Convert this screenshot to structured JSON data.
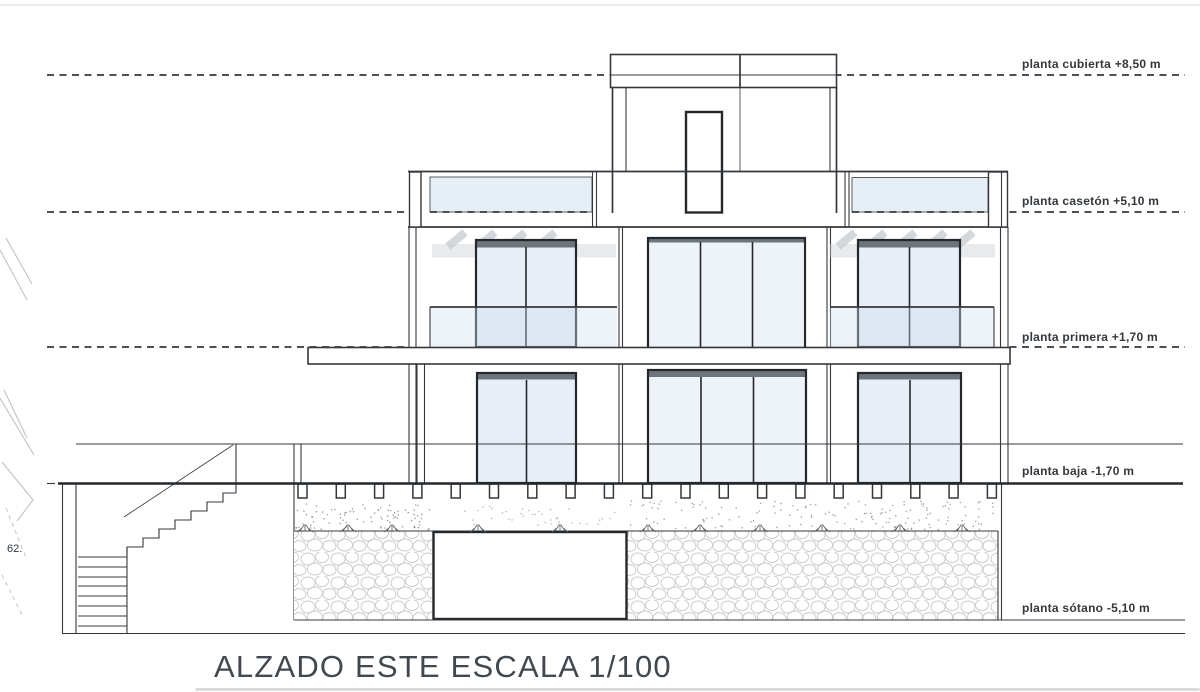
{
  "palette": {
    "line": "#34383c",
    "bold": "#24282c",
    "glass": "#cfdfee",
    "wglass": "#e7eef6",
    "wglass2": "#eef3f9",
    "header": "#6d747b",
    "shadow": "#c9cdd2",
    "stone": "#c9cac4",
    "faint": "#c2c2c2",
    "text": "#33383d",
    "title": "#424850"
  },
  "drawing": {
    "view": "ALZADO ESTE",
    "scale": "1/100"
  },
  "title": {
    "text": "ALZADO ESTE ESCALA 1/100"
  },
  "levels": [
    {
      "id": "planta-cubierta",
      "label": "planta cubierta +8,50 m",
      "elevation": "+8,50 m",
      "line_style": "dashed"
    },
    {
      "id": "planta-caseton",
      "label": "planta casetón +5,10 m",
      "elevation": "+5,10 m",
      "line_style": "dashed"
    },
    {
      "id": "planta-primera",
      "label": "planta primera +1,70 m",
      "elevation": "+1,70 m",
      "line_style": "dashed"
    },
    {
      "id": "planta-baja",
      "label": "planta baja -1,70 m",
      "elevation": "-1,70 m",
      "line_style": "solid"
    },
    {
      "id": "planta-sotano",
      "label": "planta sótano -5,10 m",
      "elevation": "-5,10 m",
      "line_style": "solid"
    }
  ],
  "annotations": {
    "stair_width": "62."
  }
}
